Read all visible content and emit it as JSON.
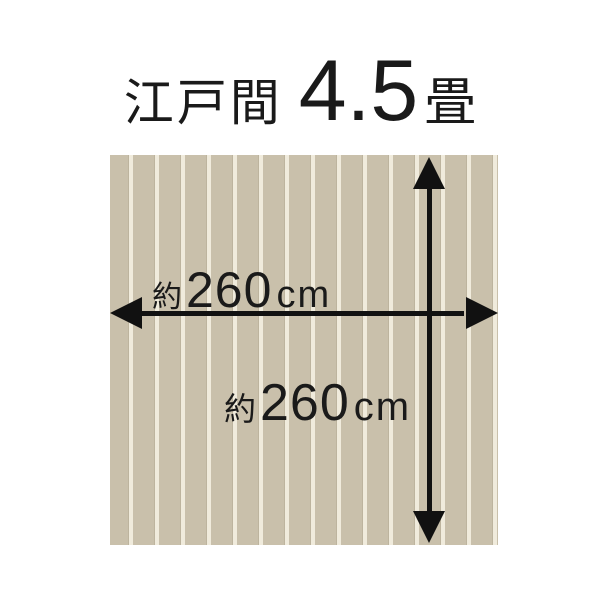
{
  "title": {
    "region": "江戸間",
    "size_value": "4.5",
    "size_unit": "畳"
  },
  "floor": {
    "width_label": {
      "prefix": "約",
      "value": "260",
      "unit": "cm"
    },
    "height_label": {
      "prefix": "約",
      "value": "260",
      "unit": "cm"
    }
  },
  "colors": {
    "background": "#ffffff",
    "text": "#1a1a1a",
    "arrow": "#111111",
    "floor_base": "#c9c0ab",
    "floor_stripe": "#f0ebdc",
    "floor_stripe_shadow": "#bdb49e"
  }
}
